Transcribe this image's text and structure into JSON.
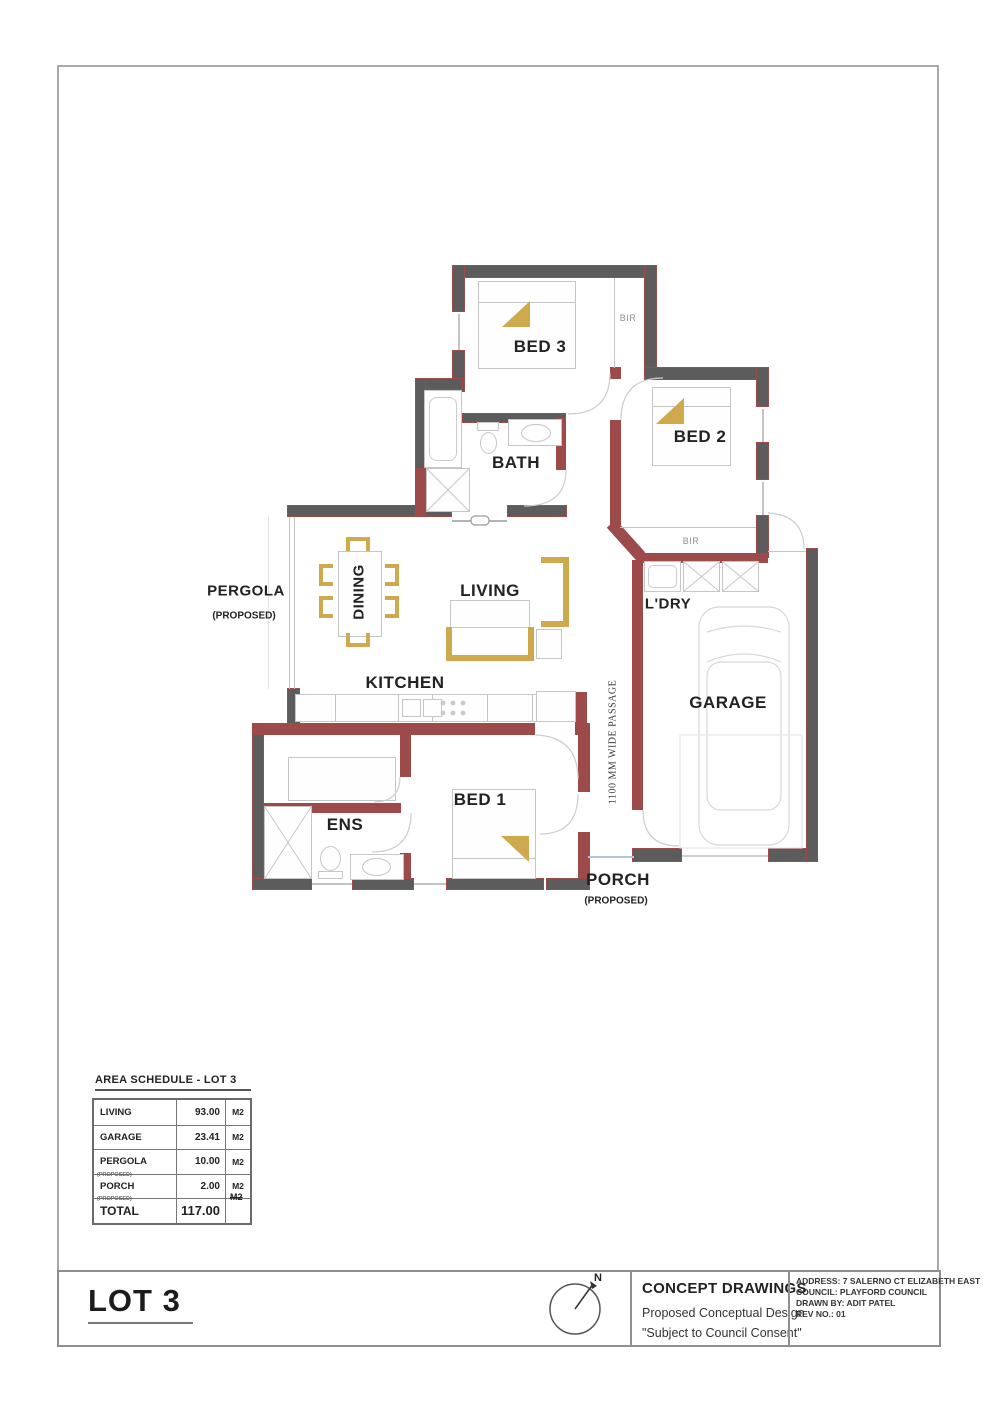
{
  "plan": {
    "labels": {
      "bed3": "BED 3",
      "bed2": "BED 2",
      "bed1": "BED 1",
      "bath": "BATH",
      "ens": "ENS",
      "living": "LIVING",
      "dining": "DINING",
      "kitchen": "KITCHEN",
      "ldry": "L'DRY",
      "garage": "GARAGE",
      "pergola": "PERGOLA",
      "pergola_note": "(PROPOSED)",
      "porch": "PORCH",
      "porch_note": "(PROPOSED)",
      "bir_bed3": "BIR",
      "bir_bed2": "BIR",
      "passage": "1100 MM WIDE PASSAGE"
    },
    "colors": {
      "wall_dark": "#5c5c5c",
      "wall_red": "#9d4a4a",
      "furniture_gold": "#cfa94e",
      "fixture_gray": "#c6c6c6"
    }
  },
  "area_schedule": {
    "title": "AREA SCHEDULE - LOT 3",
    "rows": [
      {
        "name": "LIVING",
        "note": "",
        "value": "93.00",
        "unit": "M2"
      },
      {
        "name": "GARAGE",
        "note": "",
        "value": "23.41",
        "unit": "M2"
      },
      {
        "name": "PERGOLA",
        "note": "(PROPOSED)",
        "value": "10.00",
        "unit": "M2"
      },
      {
        "name": "PORCH",
        "note": "(PROPOSED)",
        "value": "2.00",
        "unit": "M2"
      },
      {
        "name": "TOTAL",
        "note": "",
        "value": "117.00",
        "unit": "M2"
      }
    ]
  },
  "title_block": {
    "lot": "LOT 3",
    "north": "N",
    "heading": "CONCEPT DRAWINGS",
    "subheading": "Proposed Conceptual Design",
    "disclaimer": "\"Subject to Council Consent\"",
    "address": "ADDRESS: 7 SALERNO CT ELIZABETH EAST",
    "council": "COUNCIL: PLAYFORD COUNCIL",
    "drawn_by": "DRAWN BY: ADIT PATEL",
    "rev": "REV NO.: 01"
  }
}
